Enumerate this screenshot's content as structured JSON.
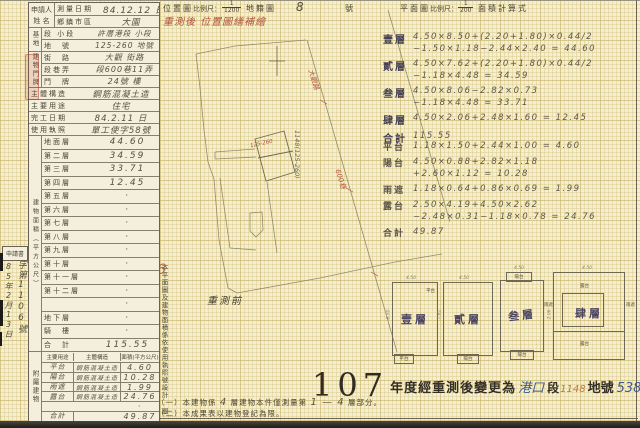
{
  "header": {
    "location_map": "位置圖",
    "scale_label": "比例尺：",
    "location_scale_num": "1",
    "location_scale_den": "1200",
    "cadastral_map": "地籍圖",
    "sheet_no": "8",
    "sheet_unit": "號",
    "floor_plan": "平面圖",
    "plan_scale_label": "比例尺：",
    "plan_scale_num": "1",
    "plan_scale_den": "200",
    "area_formula": "面積計算式"
  },
  "red_note": "重測後 位置圖繕補繪",
  "map": {
    "pre_survey_label": "重測前",
    "road_label_1": "大觀路",
    "road_label_2": "600巷",
    "parcel_note": "1148(125-260)",
    "building_label": "125-260"
  },
  "left_table": {
    "applicant": "申請人",
    "applicant2": "姓 名",
    "row_date": {
      "label": "測量日期",
      "value": "84.12.12 日"
    },
    "row_district": {
      "label": "鄉鎮市區",
      "value": "大園"
    },
    "group_site": "基地",
    "site_rows": [
      {
        "label": "段 小段",
        "value": "許厝港段 小段"
      },
      {
        "label": "地　號",
        "value": "125-260 地號"
      }
    ],
    "group_address": "建物門牌",
    "address_rows": [
      {
        "label": "街　路",
        "value": "大觀 街路"
      },
      {
        "label": "段巷弄",
        "value": "段600巷11弄"
      },
      {
        "label": "門　牌",
        "value": "24號 樓"
      }
    ],
    "full_rows": [
      {
        "label": "主體構造",
        "value": "鋼筋混凝土造"
      },
      {
        "label": "主要用途",
        "value": "住宅"
      },
      {
        "label": "完工日期",
        "value": "84.2.11 日"
      },
      {
        "label": "使用執照",
        "value": "單工使字58號"
      }
    ],
    "group_area": "建物面積（平方公尺）",
    "floor_rows": [
      {
        "label": "地面層",
        "value": "44.60"
      },
      {
        "label": "第二層",
        "value": "34.59"
      },
      {
        "label": "第三層",
        "value": "33.71"
      },
      {
        "label": "第四層",
        "value": "12.45"
      },
      {
        "label": "第五層",
        "value": "·"
      },
      {
        "label": "第六層",
        "value": "·"
      },
      {
        "label": "第七層",
        "value": "·"
      },
      {
        "label": "第八層",
        "value": "·"
      },
      {
        "label": "第九層",
        "value": "·"
      },
      {
        "label": "第十層",
        "value": "·"
      },
      {
        "label": "第十一層",
        "value": "·"
      },
      {
        "label": "第十二層",
        "value": "·"
      },
      {
        "label": "",
        "value": "·"
      },
      {
        "label": "地下層",
        "value": "·"
      },
      {
        "label": "騎　樓",
        "value": "·"
      },
      {
        "label": "合　計",
        "value": "115.55"
      }
    ],
    "group_attached": "附屬建物",
    "attached_header": {
      "use": "主要用途",
      "structure": "主體構造",
      "area": "面積(平方公尺)"
    },
    "attached_rows": [
      {
        "use": "平台",
        "structure": "鋼筋混凝土造",
        "area": "4.60"
      },
      {
        "use": "陽台",
        "structure": "鋼筋混凝土造",
        "area": "10.28"
      },
      {
        "use": "雨遮",
        "structure": "鋼筋混凝土造",
        "area": "1.99"
      },
      {
        "use": "露台",
        "structure": "鋼筋混凝土造",
        "area": "24.76"
      },
      {
        "use": "",
        "structure": "",
        "area": "·"
      },
      {
        "use": "合計",
        "structure": "",
        "area": "49.87"
      }
    ]
  },
  "margin": {
    "receipt_box": "申請書",
    "receipt_date": "85年2月13日",
    "receipt_no": "字第1106號"
  },
  "calc_floors": [
    {
      "label": "壹層",
      "l1": "4.50×8.50+(2.20+1.80)×0.44/2",
      "l2": "−1.50×1.18−2.44×2.40 = 44.60"
    },
    {
      "label": "貳層",
      "l1": "4.50×7.62+(2.20+1.80)×0.44/2",
      "l2": "−1.18×4.48 = 34.59"
    },
    {
      "label": "叁層",
      "l1": "4.50×8.06−2.82×0.73",
      "l2": "−1.18×4.48 = 33.71"
    },
    {
      "label": "肆層",
      "l1": "4.50×2.06+2.48×1.60 = 12.45",
      "l2": ""
    },
    {
      "label": "合計",
      "l1": "115.55",
      "l2": ""
    }
  ],
  "calc_attached": [
    {
      "label": "平台",
      "l1": "1.18×1.50+2.44×1.00 = 4.60",
      "l2": ""
    },
    {
      "label": "陽台",
      "l1": "4.50×0.88+2.82×1.18",
      "l2": "+2.60×1.12 = 10.28"
    },
    {
      "label": "雨遮",
      "l1": "1.18×0.64+0.86×0.69 = 1.99",
      "l2": ""
    },
    {
      "label": "露台",
      "l1": "2.50×4.19+4.50×2.62",
      "l2": "−2.48×0.31−1.18×0.78 = 24.76"
    },
    {
      "label": "合計",
      "l1": "49.87",
      "l2": ""
    }
  ],
  "vertical_note": {
    "line1": "本平面圖及建物面積係依使用執照號設計",
    "line2": "圖竣工平面圖轉繪計算之。",
    "red_mark": "56"
  },
  "plans": [
    {
      "name": "壹層",
      "top_label": "平台",
      "bottom_label": "平台",
      "side_label": "",
      "w": "4.50",
      "h": "8.50"
    },
    {
      "name": "貳層",
      "top_label": "",
      "bottom_label": "陽台",
      "side_label": "",
      "w": "4.50",
      "h": "7.62"
    },
    {
      "name": "叁層",
      "top_label": "陽台",
      "bottom_label": "陽台",
      "side_label": "雨遮",
      "w": "4.50",
      "h": "8.06"
    },
    {
      "name": "肆層",
      "top_label": "露台",
      "bottom_label": "露台",
      "side_label": "雨遮",
      "w": "4.50",
      "h": "2.06"
    }
  ],
  "bottom_stamp": {
    "year": "107",
    "text1": "年度經重測後變更為",
    "section": "港口",
    "duan": "段",
    "parcel": "1148",
    "dihao": "地號",
    "building": "538",
    "jianhao": "建號"
  },
  "footnotes": {
    "line1_prefix": "（一）本建物係",
    "line1_num": "4",
    "line1_mid": "層建物本件僅測量第",
    "line1_range": "1 — 4",
    "line1_suffix": "層部分。",
    "line2": "（二）本成果表以建物登記為限。"
  }
}
